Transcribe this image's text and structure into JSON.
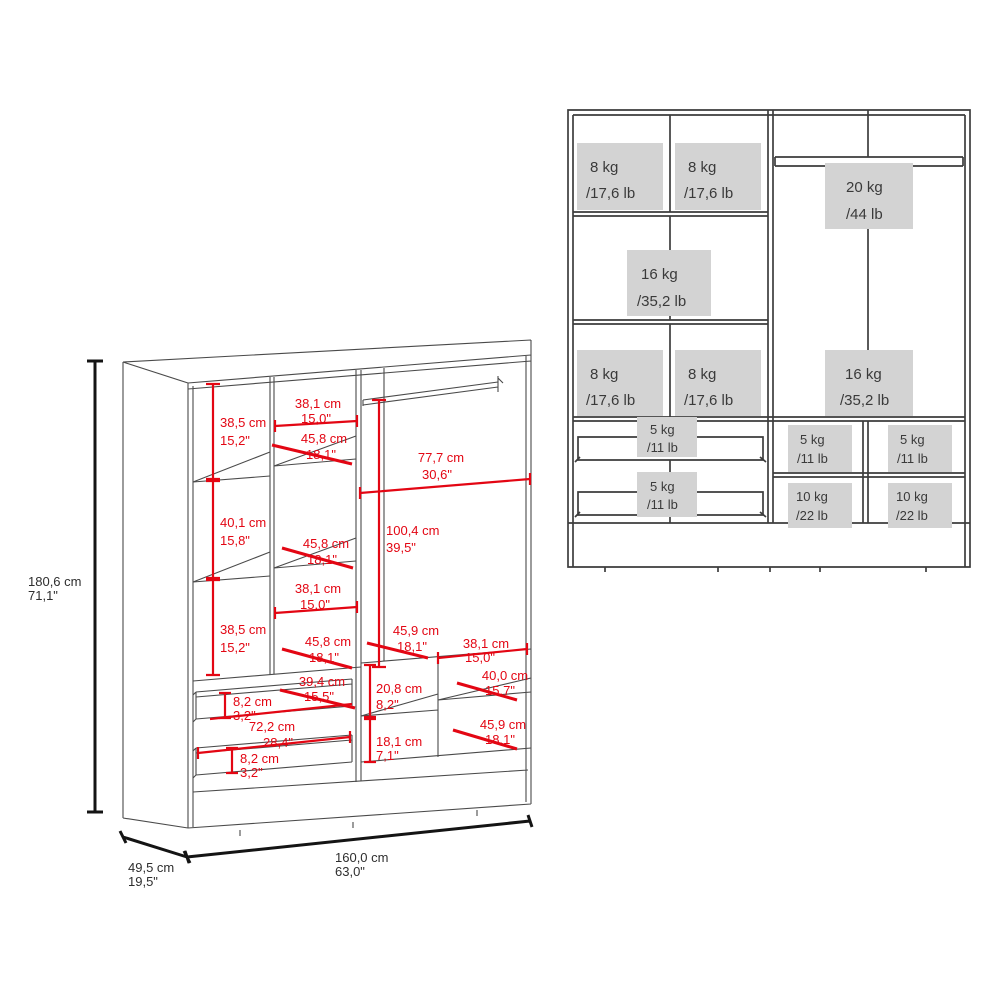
{
  "colors": {
    "dimension_red": "#e30613",
    "capacity_box_gray": "#d3d3d3",
    "line_dark": "#3d3d3d",
    "text_dark": "#3a3a3a"
  },
  "left_diagram": {
    "overall_dimensions": {
      "height": {
        "cm": "180,6 cm",
        "inches": "71,1\""
      },
      "depth": {
        "cm": "49,5 cm",
        "inches": "19,5\""
      },
      "width": {
        "cm": "160,0 cm",
        "inches": "63,0\""
      }
    },
    "internal_dimensions": [
      {
        "id": "left-upper-shelf-height",
        "cm": "38,5 cm",
        "inches": "15,2\""
      },
      {
        "id": "upper-shelf-width",
        "cm": "38,1 cm",
        "inches": "15,0\""
      },
      {
        "id": "upper-shelf-depth",
        "cm": "45,8 cm",
        "inches": "18,1\""
      },
      {
        "id": "hanging-section-width",
        "cm": "77,7 cm",
        "inches": "30,6\""
      },
      {
        "id": "left-middle-shelf-height",
        "cm": "40,1 cm",
        "inches": "15,8\""
      },
      {
        "id": "middle-shelf-depth",
        "cm": "45,8 cm",
        "inches": "18,1\""
      },
      {
        "id": "hanging-section-height",
        "cm": "100,4 cm",
        "inches": "39,5\""
      },
      {
        "id": "lower-shelf-width",
        "cm": "38,1 cm",
        "inches": "15,0\""
      },
      {
        "id": "left-lower-shelf-height",
        "cm": "38,5 cm",
        "inches": "15,2\""
      },
      {
        "id": "lower-shelf-depth",
        "cm": "45,8 cm",
        "inches": "18,1\""
      },
      {
        "id": "right-shelf-depth",
        "cm": "45,9 cm",
        "inches": "18,1\""
      },
      {
        "id": "right-shelf-width",
        "cm": "38,1 cm",
        "inches": "15,0\""
      },
      {
        "id": "right-lower-shelf-width",
        "cm": "40,0 cm",
        "inches": "15,7\""
      },
      {
        "id": "drawer-depth",
        "cm": "39,4 cm",
        "inches": "15,5\""
      },
      {
        "id": "right-compartment-height",
        "cm": "20,8 cm",
        "inches": "8,2\""
      },
      {
        "id": "drawer-front-height-top",
        "cm": "8,2 cm",
        "inches": "3,2\""
      },
      {
        "id": "drawer-width",
        "cm": "72,2 cm",
        "inches": "28,4\""
      },
      {
        "id": "right-bottom-shelf-depth",
        "cm": "45,9 cm",
        "inches": "18,1\""
      },
      {
        "id": "right-bottom-compartment-height",
        "cm": "18,1 cm",
        "inches": "7,1\""
      },
      {
        "id": "drawer-front-height-bottom",
        "cm": "8,2 cm",
        "inches": "3,2\""
      }
    ]
  },
  "right_diagram": {
    "capacities": [
      {
        "id": "top-left-shelf",
        "kg": "8 kg",
        "lb": "/17,6 lb"
      },
      {
        "id": "top-middle-shelf",
        "kg": "8 kg",
        "lb": "/17,6 lb"
      },
      {
        "id": "hanging-rail",
        "kg": "20 kg",
        "lb": "/44 lb"
      },
      {
        "id": "middle-shelf",
        "kg": "16 kg",
        "lb": "/35,2 lb"
      },
      {
        "id": "lower-left-shelf",
        "kg": "8 kg",
        "lb": "/17,6 lb"
      },
      {
        "id": "lower-middle-shelf",
        "kg": "8 kg",
        "lb": "/17,6 lb"
      },
      {
        "id": "right-section",
        "kg": "16 kg",
        "lb": "/35,2 lb"
      },
      {
        "id": "drawer-1",
        "kg": "5 kg",
        "lb": "/11 lb"
      },
      {
        "id": "drawer-2",
        "kg": "5 kg",
        "lb": "/11 lb"
      },
      {
        "id": "right-shelf-left",
        "kg": "5 kg",
        "lb": "/11 lb"
      },
      {
        "id": "right-shelf-right",
        "kg": "5 kg",
        "lb": "/11 lb"
      },
      {
        "id": "right-bottom-left",
        "kg": "10 kg",
        "lb": "/22 lb"
      },
      {
        "id": "right-bottom-right",
        "kg": "10 kg",
        "lb": "/22 lb"
      }
    ]
  }
}
